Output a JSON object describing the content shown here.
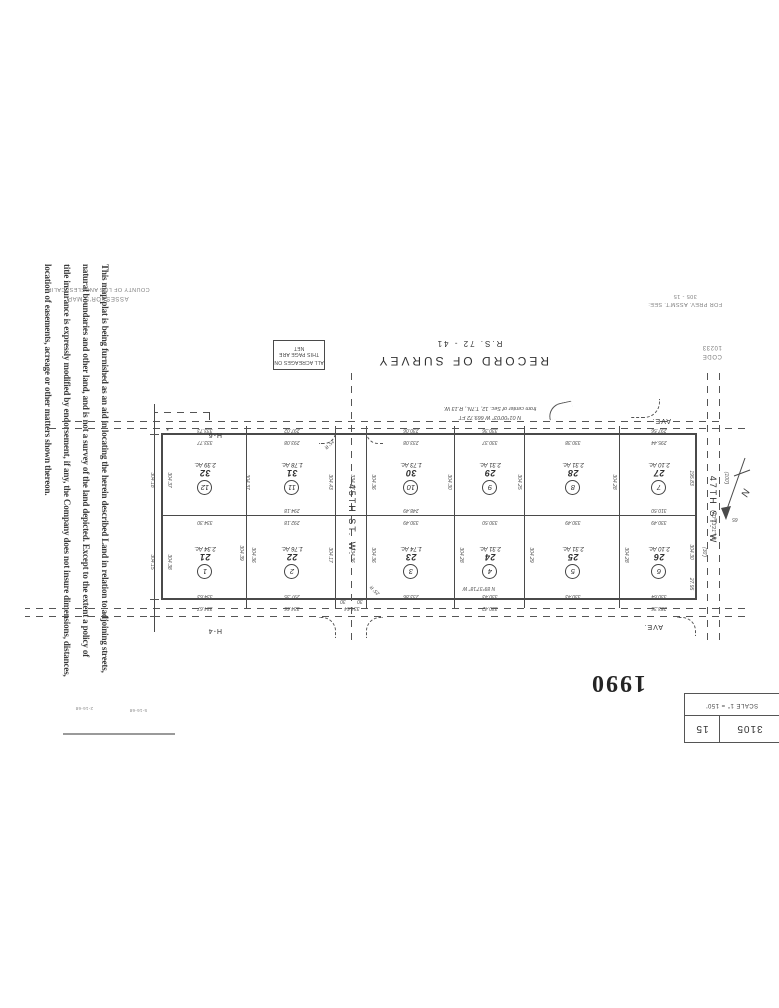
{
  "document": {
    "title": "RECORD OF SURVEY",
    "survey_ref": "R.S. 72 - 41"
  },
  "disclaimer_text": "This map/plat is being furnished as an aid in locating the herein described Land in relation to adjoining streets,\nnatural boundaries and other land, and is not a survey of the land depicted. Except to the extent a policy of\ntitle insurance is expressly modified by endorsement, if any, the Company does not insure dimensions, distances,\nlocation of easements, acreage or other matters shown thereon.",
  "header_box": {
    "book": "3105",
    "page": "15",
    "scale_text": "SCALE 1\" = 150'"
  },
  "year_stamp": "1990",
  "revision_marks": [
    "5-16-68",
    "2-16-68"
  ],
  "stamps": {
    "assessors_map": "ASSESSOR'S MAP",
    "county": "COUNTY OF LOS ANGELES, CALIF.",
    "prev_assmt": "FOR PREV. ASSM'T. SEE:",
    "prev_assmt_ref": "305 - 15",
    "code_label": "CODE",
    "code_value": "10233",
    "acreage_note_line1": "ALL ACREAGES ON",
    "acreage_note_line2": "THIS PAGE ARE NET"
  },
  "streets": {
    "cross_street": "45TH  ST. W.",
    "side_street": "47TH  ST. W",
    "ave_label_top": "AVE.",
    "ave_name_top": "H-4",
    "ave_label_bottom": "AVE.",
    "ave_name_bottom": "H-6",
    "adjacent_sheet_number": "65"
  },
  "corner_note": {
    "line1": "N 01°00'03\" W  669.72 FT",
    "line2": "from center of Sec. 12, T.7N., R.13 W."
  },
  "lots": [
    {
      "lot": "26",
      "parcel_circle": "6",
      "acres": "2.10 Ac.",
      "row": "top",
      "col": 0
    },
    {
      "lot": "25",
      "parcel_circle": "5",
      "acres": "2.31 Ac.",
      "row": "top",
      "col": 1
    },
    {
      "lot": "24",
      "parcel_circle": "4",
      "acres": "2.31 Ac.",
      "row": "top",
      "col": 2
    },
    {
      "lot": "23",
      "parcel_circle": "3",
      "acres": "1.74 Ac.",
      "row": "top",
      "col": 3
    },
    {
      "lot": "22",
      "parcel_circle": "2",
      "acres": "1.76 Ac.",
      "row": "top",
      "col": 5
    },
    {
      "lot": "21",
      "parcel_circle": "1",
      "acres": "2.34 Ac.",
      "row": "top",
      "col": 6
    },
    {
      "lot": "27",
      "parcel_circle": "7",
      "acres": "2.10 Ac.",
      "row": "bottom",
      "col": 0
    },
    {
      "lot": "28",
      "parcel_circle": "8",
      "acres": "2.31 Ac.",
      "row": "bottom",
      "col": 1
    },
    {
      "lot": "29",
      "parcel_circle": "9",
      "acres": "2.31 Ac.",
      "row": "bottom",
      "col": 2
    },
    {
      "lot": "30",
      "parcel_circle": "10",
      "acres": "1.73 Ac.",
      "row": "bottom",
      "col": 3
    },
    {
      "lot": "31",
      "parcel_circle": "11",
      "acres": "1.78 Ac.",
      "row": "bottom",
      "col": 5
    },
    {
      "lot": "32",
      "parcel_circle": "12",
      "acres": "2.39 Ac.",
      "row": "bottom",
      "col": 6
    }
  ],
  "dimensions": [
    {
      "t": "283.36",
      "x": 120,
      "y": 152
    },
    {
      "t": "330.64",
      "x": 120,
      "y": 164
    },
    {
      "t": "330.43",
      "x": 206,
      "y": 164
    },
    {
      "t": "330.42",
      "x": 289,
      "y": 152
    },
    {
      "t": "330.43",
      "x": 289,
      "y": 164
    },
    {
      "t": "N 89°37'18\" W",
      "x": 300,
      "y": 172
    },
    {
      "t": "233.86",
      "x": 368,
      "y": 164
    },
    {
      "t": "334.64",
      "x": 427,
      "y": 152
    },
    {
      "t": "334.66",
      "x": 487,
      "y": 152
    },
    {
      "t": "297.35",
      "x": 487,
      "y": 164
    },
    {
      "t": "334.67",
      "x": 574,
      "y": 152
    },
    {
      "t": "334.63",
      "x": 574,
      "y": 164
    },
    {
      "t": "330.49",
      "x": 120,
      "y": 238
    },
    {
      "t": "310.50",
      "x": 120,
      "y": 250
    },
    {
      "t": "330.49",
      "x": 206,
      "y": 238
    },
    {
      "t": "330.50",
      "x": 289,
      "y": 238
    },
    {
      "t": "330.49",
      "x": 368,
      "y": 238
    },
    {
      "t": "248.49",
      "x": 368,
      "y": 250
    },
    {
      "t": "292.18",
      "x": 487,
      "y": 238
    },
    {
      "t": "294.18",
      "x": 487,
      "y": 250
    },
    {
      "t": "334.30",
      "x": 574,
      "y": 238
    },
    {
      "t": "295.44",
      "x": 120,
      "y": 318
    },
    {
      "t": "297.56",
      "x": 120,
      "y": 330
    },
    {
      "t": "330.38",
      "x": 206,
      "y": 318
    },
    {
      "t": "330.37",
      "x": 289,
      "y": 318
    },
    {
      "t": "330.36",
      "x": 289,
      "y": 330
    },
    {
      "t": "233.08",
      "x": 368,
      "y": 318
    },
    {
      "t": "230.06",
      "x": 368,
      "y": 330
    },
    {
      "t": "293.08",
      "x": 487,
      "y": 318
    },
    {
      "t": "297.02",
      "x": 487,
      "y": 330
    },
    {
      "t": "333.77",
      "x": 574,
      "y": 318
    },
    {
      "t": "333.73",
      "x": 574,
      "y": 330
    },
    {
      "t": "27.95",
      "x": 88,
      "y": 176,
      "r": -90
    },
    {
      "t": "304.30",
      "x": 88,
      "y": 208,
      "r": -90
    },
    {
      "t": "195.83",
      "x": 88,
      "y": 282,
      "r": -90
    },
    {
      "t": "N 0°13'21\" W",
      "x": 66,
      "y": 235,
      "r": -90
    },
    {
      "t": "(30')",
      "x": 75,
      "y": 208,
      "r": -90
    },
    {
      "t": "(100')",
      "x": 53,
      "y": 282,
      "r": -90
    },
    {
      "t": "304.28",
      "x": 153,
      "y": 205,
      "r": -90
    },
    {
      "t": "304.28",
      "x": 165,
      "y": 278,
      "r": -90
    },
    {
      "t": "304.29",
      "x": 248,
      "y": 205,
      "r": -90
    },
    {
      "t": "304.25",
      "x": 260,
      "y": 278,
      "r": -90
    },
    {
      "t": "304.28",
      "x": 318,
      "y": 205,
      "r": -90
    },
    {
      "t": "304.30",
      "x": 330,
      "y": 278,
      "r": -90
    },
    {
      "t": "304.36",
      "x": 406,
      "y": 205,
      "r": -90
    },
    {
      "t": "304.36",
      "x": 406,
      "y": 278,
      "r": -90
    },
    {
      "t": "334.36",
      "x": 427,
      "y": 205,
      "r": -90
    },
    {
      "t": "334.17",
      "x": 427,
      "y": 278,
      "r": -90
    },
    {
      "t": "304.17",
      "x": 449,
      "y": 205,
      "r": -90
    },
    {
      "t": "304.43",
      "x": 449,
      "y": 278,
      "r": -90
    },
    {
      "t": "304.36",
      "x": 526,
      "y": 205,
      "r": -90
    },
    {
      "t": "304.39",
      "x": 538,
      "y": 207,
      "r": -90
    },
    {
      "t": "304.37",
      "x": 532,
      "y": 278,
      "r": -90
    },
    {
      "t": "304.38",
      "x": 610,
      "y": 198,
      "r": -90
    },
    {
      "t": "304.15",
      "x": 627,
      "y": 198,
      "r": -90
    },
    {
      "t": "304.37",
      "x": 610,
      "y": 280,
      "r": -90
    },
    {
      "t": "304.18",
      "x": 627,
      "y": 280,
      "r": -90
    },
    {
      "t": "30",
      "x": 419,
      "y": 159
    },
    {
      "t": "30",
      "x": 436,
      "y": 159
    },
    {
      "t": "25' R",
      "x": 404,
      "y": 170,
      "r": 45
    },
    {
      "t": "25' R",
      "x": 450,
      "y": 316,
      "r": -45
    },
    {
      "t": "65",
      "x": 44,
      "y": 241
    }
  ]
}
